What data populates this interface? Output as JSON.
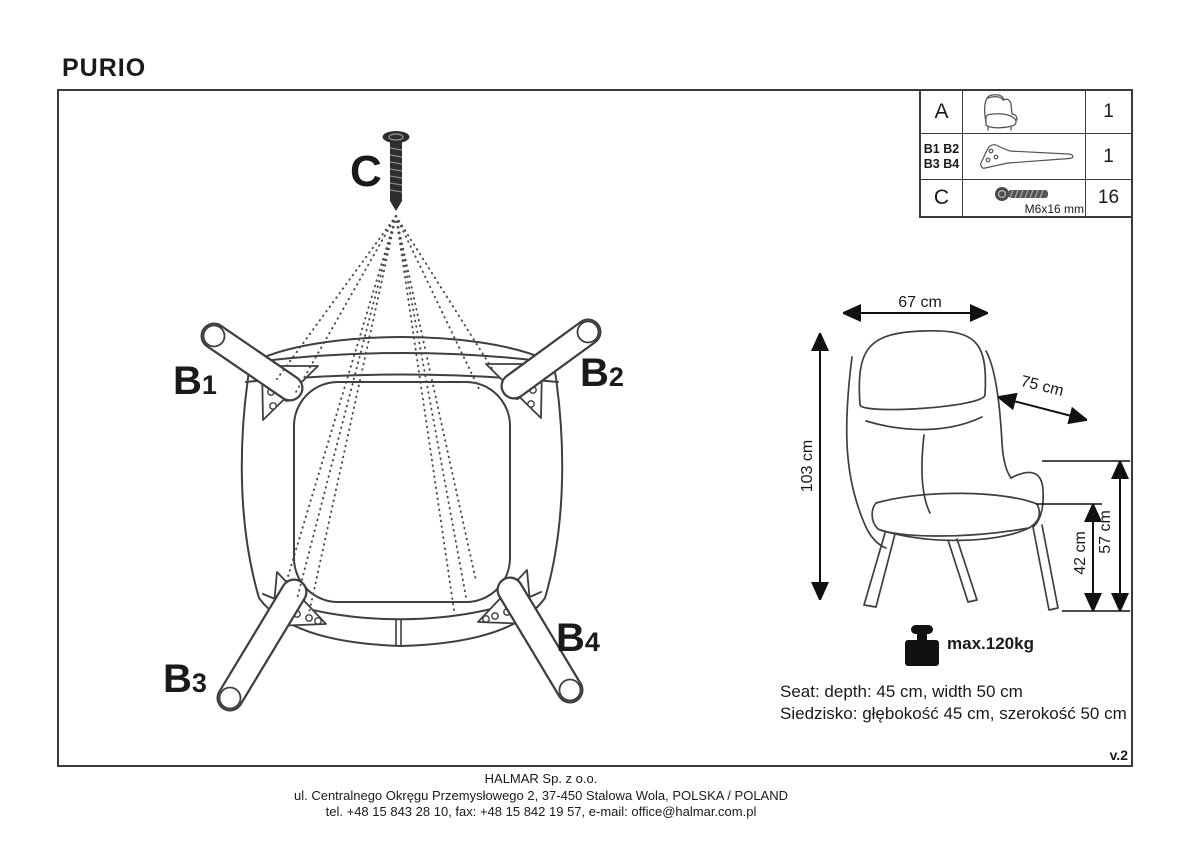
{
  "title": "PURIO",
  "version_label": "v.2",
  "parts_table": {
    "rows": [
      {
        "label": "A",
        "icon": "armchair-icon",
        "qty": "1"
      },
      {
        "label_line1": "B1 B2",
        "label_line2": "B3 B4",
        "icon": "leg-bracket-icon",
        "qty": "1"
      },
      {
        "label": "C",
        "icon": "screw-icon",
        "spec": "M6x16 mm",
        "qty": "16"
      }
    ]
  },
  "assembly": {
    "screw_label": "C",
    "leg_labels": [
      {
        "letter": "B",
        "num": "1"
      },
      {
        "letter": "B",
        "num": "2"
      },
      {
        "letter": "B",
        "num": "3"
      },
      {
        "letter": "B",
        "num": "4"
      }
    ]
  },
  "dimensions": {
    "width": "67 cm",
    "depth": "75 cm",
    "height": "103 cm",
    "total_seat_height": "57 cm",
    "seat_height": "42 cm"
  },
  "max_load": {
    "icon": "weight-icon",
    "label": "max.120kg"
  },
  "seat_info": {
    "en": "Seat: depth: 45 cm, width 50 cm",
    "pl": "Siedzisko: głębokość 45 cm, szerokość 50 cm"
  },
  "footer": {
    "company": "HALMAR Sp. z o.o.",
    "address": "ul. Centralnego Okręgu Przemysłowego 2, 37-450 Stalowa Wola, POLSKA / POLAND",
    "contact": "tel. +48 15 843 28 10, fax: +48 15 842 19 57, e-mail: office@halmar.com.pl"
  }
}
